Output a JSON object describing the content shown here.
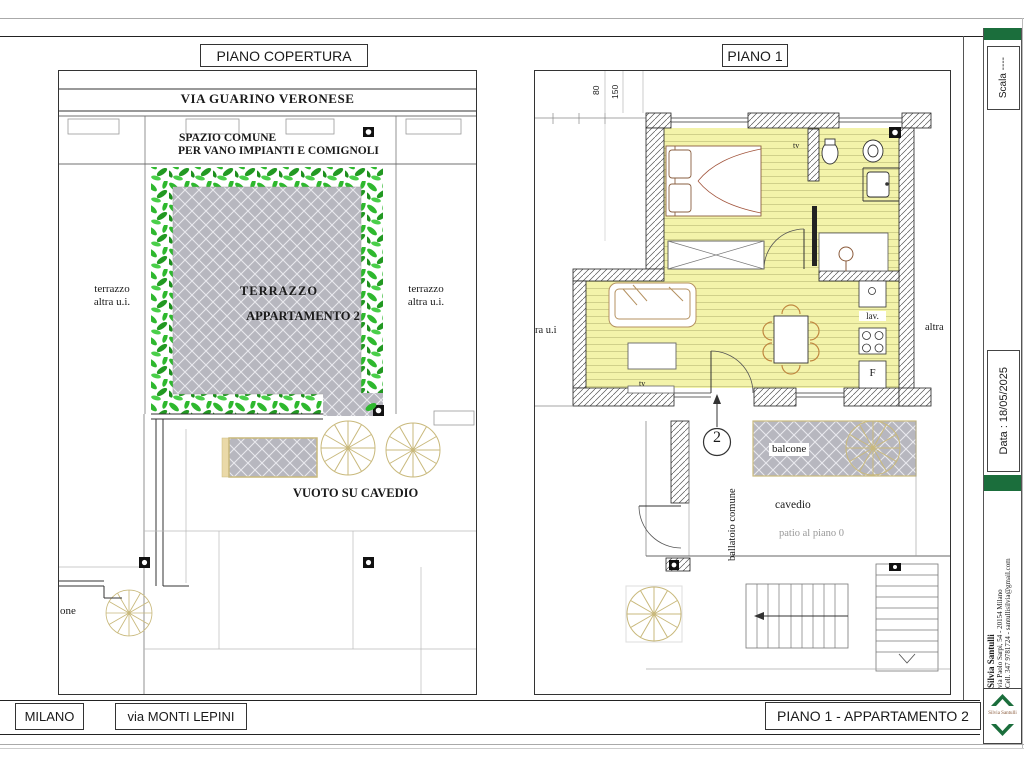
{
  "left_plan": {
    "title": "PIANO COPERTURA",
    "street_label": "VIA GUARINO VERONESE",
    "common_line1": "SPAZIO COMUNE",
    "common_line2": "PER VANO IMPIANTI E COMIGNOLI",
    "terrace_line1": "TERRAZZO",
    "terrace_line2": "APPARTAMENTO 2",
    "left_terrace_line1": "terrazzo",
    "left_terrace_line2": "altra u.i.",
    "right_terrace_line1": "terrazzo",
    "right_terrace_line2": "altra u.i.",
    "void_label": "VUOTO SU CAVEDIO",
    "clipped_balcone": "one"
  },
  "right_plan": {
    "title": "PIANO 1",
    "dim_80": "80",
    "dim_150": "150",
    "tv_bathroom": "tv",
    "tv_living": "tv",
    "sink_label": "lav.",
    "fridge_label": "F",
    "balcony_label": "balcone",
    "cavedio_label": "cavedio",
    "patio_label": "patio al piano 0",
    "walkway_label": "ballatoio comune",
    "unit_number": "2",
    "clipped_left": "ra u.i",
    "clipped_right": "altra"
  },
  "sidebar": {
    "scale_label": "Scala ----",
    "date_label": "Data : 18/05/2025",
    "contact_name": "Silvia Santulli",
    "contact_address": "via Paolo Sarpi, 54 - 20154 Milano",
    "contact_phone": "Cell. 347 9781724 - santullisilvia@gmail.com",
    "logo_text": "Silvia Santulli"
  },
  "footer": {
    "city": "MILANO",
    "street": "via MONTI LEPINI",
    "plan_title": "PIANO 1 - APPARTAMENTO 2"
  },
  "colors": {
    "accent_green": "#1b6e3c",
    "hedge_green": "#2eb82e",
    "floor_yellow": "#f3f3aa",
    "paving_gray": "#b7b7bf"
  }
}
